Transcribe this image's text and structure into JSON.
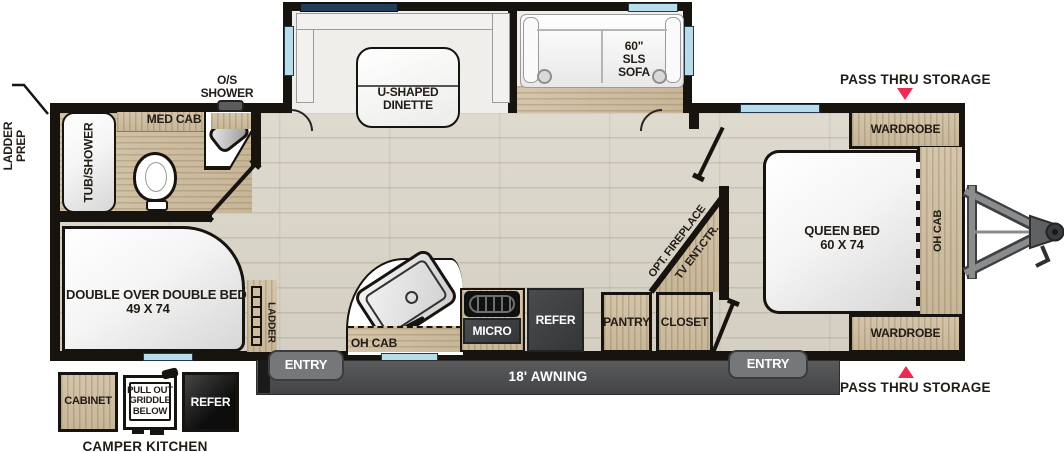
{
  "colors": {
    "accent_red": "#ee2a52",
    "wall": "#17130f",
    "floor_wood": "#d8d3c6",
    "cabinet_wood": "#cdbca0",
    "window_light": "#b9dcea",
    "window_dark": "#243d58",
    "appliance_dark": "#3b3c3e",
    "awning_gray": "#4b4c4e"
  },
  "exterior": {
    "ladder_prep": {
      "line1": "LADDER",
      "line2": "PREP"
    },
    "pass_thru_top": "PASS THRU STORAGE",
    "pass_thru_bottom": "PASS THRU STORAGE",
    "awning": "18' AWNING",
    "entry_rear": "ENTRY",
    "entry_front": "ENTRY",
    "camper_kitchen": {
      "title": "CAMPER KITCHEN",
      "cabinet": "CABINET",
      "griddle": {
        "line1": "PULL OUT",
        "line2": "GRIDDLE",
        "line3": "BELOW"
      },
      "refer": "REFER"
    }
  },
  "slideout": {
    "dinette": {
      "line1": "U-SHAPED",
      "line2": "DINETTE"
    },
    "sofa": {
      "line1": "60\"",
      "line2": "SLS",
      "line3": "SOFA"
    }
  },
  "bathroom": {
    "tub": "TUB/SHOWER",
    "med_cab": "MED CAB",
    "os_shower": {
      "line1": "O/S",
      "line2": "SHOWER"
    }
  },
  "bunk_room": {
    "bed": {
      "line1": "DOUBLE OVER DOUBLE BEDS",
      "line2": "49 X 74"
    },
    "ladder": "LADDER"
  },
  "kitchen": {
    "oh_cab": "OH CAB",
    "micro": "MICRO",
    "refer": "REFER",
    "pantry": "PANTRY",
    "closet": "CLOSET"
  },
  "living": {
    "fireplace": "OPT. FIREPLACE",
    "tv": "TV ENT.CTR."
  },
  "bedroom": {
    "wardrobe_top": "WARDROBE",
    "wardrobe_bottom": "WARDROBE",
    "bed": {
      "line1": "QUEEN BED",
      "line2": "60 X 74"
    },
    "oh_cab": "OH CAB"
  }
}
